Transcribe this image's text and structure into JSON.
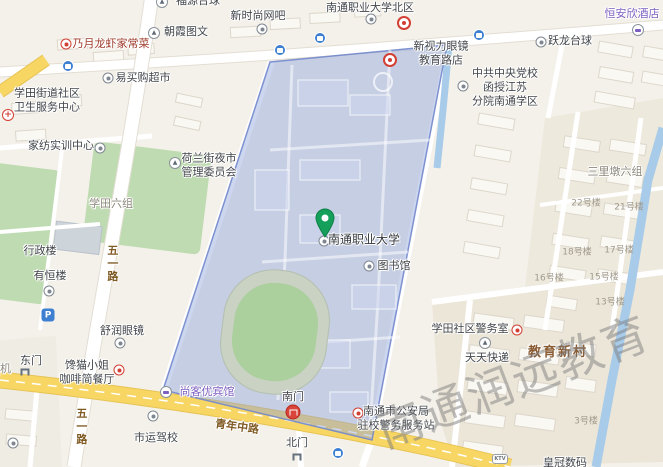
{
  "watermark": "南通润远教育",
  "colors": {
    "campus_fill": "#8fa3dc",
    "campus_stroke": "#7287cc",
    "road_yellow": "#f7d664",
    "water_blue": "#a7cbe8",
    "poi_red": "#d23f33",
    "hotel_purple": "#7d5fc0",
    "pin_green": "#14a05a"
  },
  "pois": {
    "fuyuan_billiards": "福源台球",
    "chaoxia": "朝霞图文",
    "naiyue": "乃月龙虾家常菜",
    "xinshishang": "新时尚网吧",
    "beiqu": "南通职业大学北区",
    "xinshili_1": "新视力眼镜",
    "xinshili_2": "教育路店",
    "hengan": "恒安欣酒店",
    "yuelong": "跃龙台球",
    "yimai": "易买购超市",
    "dangxiao_1": "中共中央党校",
    "dangxiao_2": "函授江苏",
    "dangxiao_3": "分院南通学区",
    "weisheng_1": "学田街道社区",
    "weisheng_2": "卫生服务中心",
    "jiafang": "家纺实训中心",
    "helan_1": "荷兰街夜市",
    "helan_2": "管理委员会",
    "xingzheng": "行政楼",
    "youheng": "有恒楼",
    "shurun": "舒润眼镜",
    "chanmao_1": "馋猫小姐",
    "chanmao_2": "咖啡简餐厅",
    "dianji": "电机",
    "shiyun": "市运驾校",
    "shangkeyou": "尚客优宾馆",
    "tushuguan": "图书馆",
    "main_univ": "南通职业大学",
    "jingwushi": "学田社区警务室",
    "tiantian": "天天快递",
    "gongan_1": "南通市公安局",
    "gongan_2": "驻校警务服务站",
    "huangguan": "皇冠数码",
    "parking": "P",
    "ktv": "KTV"
  },
  "districts": {
    "xuetian6": "学田六组",
    "sanlidun6": "三里墩六组",
    "jiaoyu_xincun": "教育新村"
  },
  "roads": {
    "wuyi": "五一路",
    "qingnian": "青年中路"
  },
  "gates": {
    "east": "东门",
    "south": "南门",
    "north": "北门"
  },
  "buildings": {
    "b22": "22号楼",
    "b21": "21号楼",
    "b18": "18号楼",
    "b17": "17号楼",
    "b16": "16号楼",
    "b15": "15号楼",
    "b13": "13号楼",
    "b3": "3号楼"
  }
}
